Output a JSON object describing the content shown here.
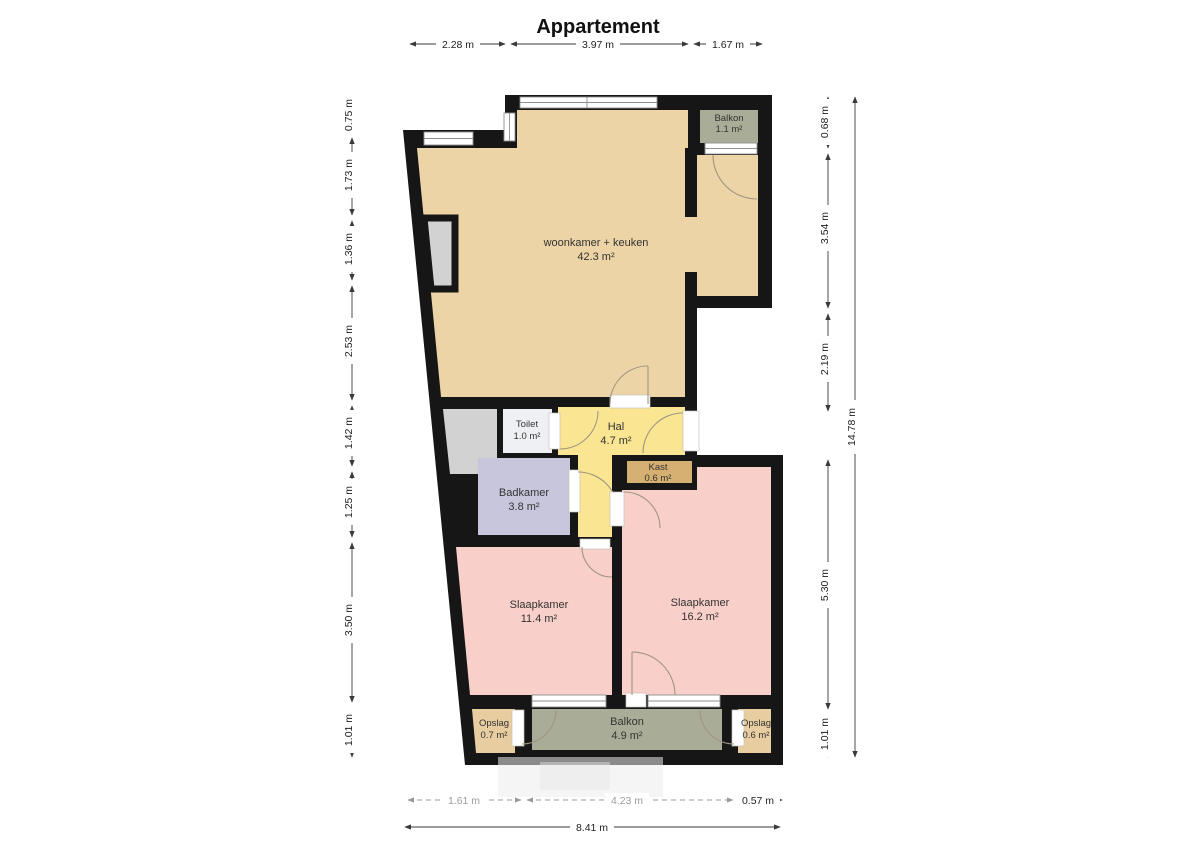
{
  "title": "Appartement",
  "rooms": {
    "balkon_top": {
      "name": "Balkon",
      "area": "1.1 m²"
    },
    "woonkamer": {
      "name": "woonkamer + keuken",
      "area": "42.3 m²"
    },
    "toilet": {
      "name": "Toilet",
      "area": "1.0 m²"
    },
    "hal": {
      "name": "Hal",
      "area": "4.7 m²"
    },
    "kast": {
      "name": "Kast",
      "area": "0.6 m²"
    },
    "badkamer": {
      "name": "Badkamer",
      "area": "3.8 m²"
    },
    "slaapkamer_links": {
      "name": "Slaapkamer",
      "area": "11.4 m²"
    },
    "slaapkamer_rechts": {
      "name": "Slaapkamer",
      "area": "16.2 m²"
    },
    "opslag_links": {
      "name": "Opslag",
      "area": "0.7 m²"
    },
    "balkon_onder": {
      "name": "Balkon",
      "area": "4.9 m²"
    },
    "opslag_rechts": {
      "name": "Opslag",
      "area": "0.6 m²"
    }
  },
  "dimensions": {
    "top": [
      "2.28 m",
      "3.97 m",
      "1.67 m"
    ],
    "left": [
      "0.75 m",
      "1.73 m",
      "1.36 m",
      "2.53 m",
      "1.42 m",
      "1.25 m",
      "3.50 m",
      "1.01 m"
    ],
    "right": [
      "0.68 m",
      "3.54 m",
      "2.19 m",
      "5.30 m",
      "1.01 m"
    ],
    "right_total": "14.78 m",
    "bottom": [
      "1.61 m",
      "4.23 m",
      "0.57 m"
    ],
    "bottom_total": "8.41 m"
  },
  "colors": {
    "wall": "#161616",
    "woonkamer": "#edd4a6",
    "hal": "#f9e592",
    "badkamer": "#c7c6dc",
    "slaapkamer": "#f9cfc9",
    "balkon": "#a9ad97",
    "kast": "#d6b072",
    "opslag": "#e7cda0",
    "toilet": "#eef0f4",
    "shaft": "#d2d2d2"
  }
}
